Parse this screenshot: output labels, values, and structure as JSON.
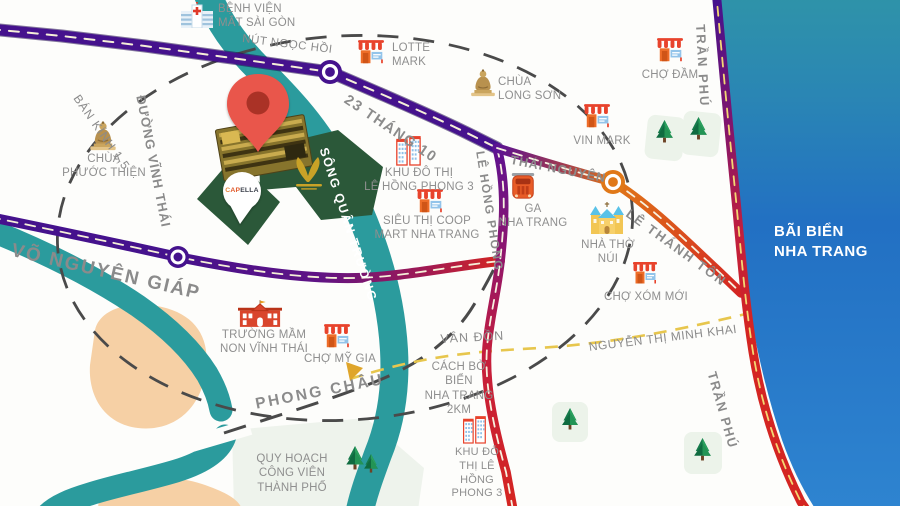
{
  "map_title": "Nha Trang project location map",
  "colors": {
    "road_purple": "#45128d",
    "road_red": "#d42522",
    "road_orange": "#e07818",
    "river_teal": "#2b9b9d",
    "ocean_top": "#2f94a8",
    "ocean_bottom": "#2e84d0",
    "land_peach": "#f6d0a5",
    "project_green": "#2b5839",
    "pin_red": "#e9564b",
    "dash_yellow": "#e7c64d",
    "label_gray": "#8f8f8f"
  },
  "brand": {
    "name": "CAPELLA",
    "pre": "C",
    "mid": "AP",
    "suf": "ELLA"
  },
  "ocean": {
    "label": "BÃI BIỂN\nNHA TRANG"
  },
  "roads": [
    {
      "id": "nut-ngoc-hoi",
      "name": "NÚT NGỌC HỒI"
    },
    {
      "id": "23-thang-10",
      "name": "23 THÁNG 10"
    },
    {
      "id": "tran-phu-top",
      "name": "TRẦN PHÚ"
    },
    {
      "id": "duong-vinh-thai",
      "name": "ĐƯỜNG VĨNH THÁI"
    },
    {
      "id": "ban-kinh-1-5",
      "name": "BÁN KÍNH 1,5"
    },
    {
      "id": "vo-nguyen-giap",
      "name": "VÕ NGUYÊN GIÁP"
    },
    {
      "id": "song-quan-truong",
      "name": "SÔNG QUÂN TRƯỜNG"
    },
    {
      "id": "le-hong-phong",
      "name": "LÊ HỒNG PHONG"
    },
    {
      "id": "thai-nguyen",
      "name": "THÁI NGUYÊN"
    },
    {
      "id": "le-thanh-ton",
      "name": "LÊ THÁNH TÔN"
    },
    {
      "id": "van-don",
      "name": "VÂN ĐỒN"
    },
    {
      "id": "nguyen-thi-minh-khai",
      "name": "NGUYỄN THỊ MINH KHAI"
    },
    {
      "id": "phong-chau",
      "name": "PHONG CHÂU"
    },
    {
      "id": "tran-phu-bottom",
      "name": "TRẦN PHÚ"
    }
  ],
  "pois": [
    {
      "id": "benh-vien-mat-sai-gon",
      "label": "BỆNH VIỆN\nMẮT SÀI GÒN",
      "icon": "hospital-icon"
    },
    {
      "id": "lotte-mark",
      "label": "LOTTE\nMARK",
      "icon": "market-icon"
    },
    {
      "id": "chua-long-son",
      "label": "CHÙA\nLONG SƠN",
      "icon": "buddha-icon"
    },
    {
      "id": "cho-dam",
      "label": "CHỢ ĐẦM",
      "icon": "market-icon"
    },
    {
      "id": "vin-mark",
      "label": "VIN MARK",
      "icon": "market-icon"
    },
    {
      "id": "chua-phuoc-thien",
      "label": "CHÙA\nPHƯỚC THIỆN",
      "icon": "buddha-icon"
    },
    {
      "id": "khu-do-thi-le-hong-phong-3",
      "label": "KHU ĐÔ THỊ\nLÊ HỒNG PHONG 3",
      "icon": "towers-icon"
    },
    {
      "id": "sieu-thi-coop-mart",
      "label": "SIÊU THỊ COOP\nMART NHA TRANG",
      "icon": "market-icon"
    },
    {
      "id": "ga-nha-trang",
      "label": "GA\nNHA TRANG",
      "icon": "train-icon"
    },
    {
      "id": "nha-tho-nui",
      "label": "NHÀ THỜ\nNÚI",
      "icon": "church-icon"
    },
    {
      "id": "cho-xom-moi",
      "label": "CHỢ XÓM MỚI",
      "icon": "market-icon"
    },
    {
      "id": "truong-mam-non-vinh-thai",
      "label": "TRƯỜNG MẦM\nNON VĨNH THÁI",
      "icon": "school-icon"
    },
    {
      "id": "cho-my-gia",
      "label": "CHỢ MỸ GIA",
      "icon": "market-icon"
    },
    {
      "id": "cach-bo-bien",
      "label": "CÁCH BỜ\nBIỂN\nNHA TRANG\n2KM",
      "icon": ""
    },
    {
      "id": "khu-do-thi-le-hong-phong-3-south",
      "label": "KHU ĐÔ\nTHỊ LÊ\nHỒNG\nPHONG 3",
      "icon": "towers-icon"
    },
    {
      "id": "quy-hoach-cong-vien",
      "label": "QUY HOẠCH\nCÔNG VIÊN\nTHÀNH PHỐ",
      "icon": "trees-icon"
    }
  ]
}
